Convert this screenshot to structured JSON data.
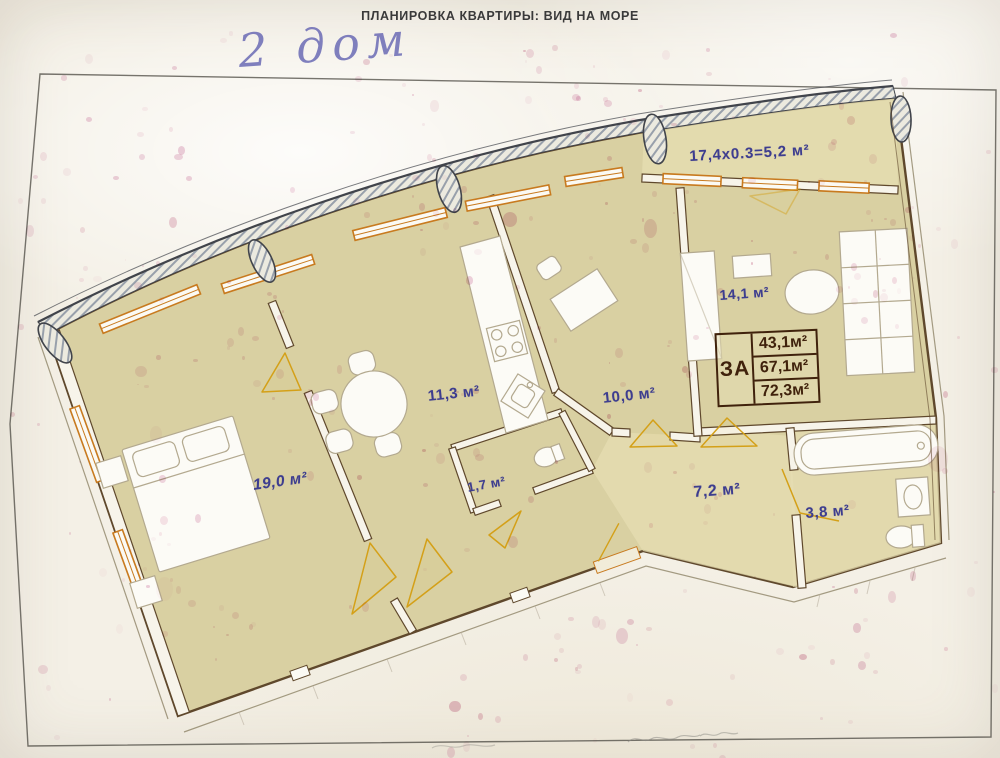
{
  "header": {
    "title": "ПЛАНИРОВКА КВАРТИРЫ: ВИД НА МОРЕ"
  },
  "handwritten_note": "2 дом",
  "plan": {
    "balcony_note": "17,4x0.3=5,2 м²",
    "rooms": [
      {
        "id": "bedroom",
        "area_label": "19,0 м²"
      },
      {
        "id": "kitchen-dining",
        "area_label": "11,3 м²"
      },
      {
        "id": "wc",
        "area_label": "1,7 м²"
      },
      {
        "id": "room",
        "area_label": "10,0 м²"
      },
      {
        "id": "bedroom-2",
        "area_label": "14,1 м²"
      },
      {
        "id": "hallway",
        "area_label": "7,2 м²"
      },
      {
        "id": "bathroom",
        "area_label": "3,8 м²"
      }
    ],
    "area_table": {
      "row_header": "ЗА",
      "values": [
        "43,1м²",
        "67,1м²",
        "72,3м²"
      ]
    }
  },
  "colors": {
    "paper": "#f4f0e6",
    "plan_fill": "#d9d0a2",
    "plan_fill_light": "#e5ddb2",
    "wall": "#5f482c",
    "facade_dark": "#41444b",
    "hatch": "#98a0ab",
    "window_frame": "#c87a1f",
    "door_mark": "#d4a018",
    "label_blue": "#3d3d8f",
    "table_ink": "#40220c",
    "speckle": "#c2558c",
    "handwriting_blue": "#6b6bb5",
    "title_ink": "#3a3a3a",
    "border_line": "#55534b",
    "furniture_line": "#b3a98f"
  }
}
